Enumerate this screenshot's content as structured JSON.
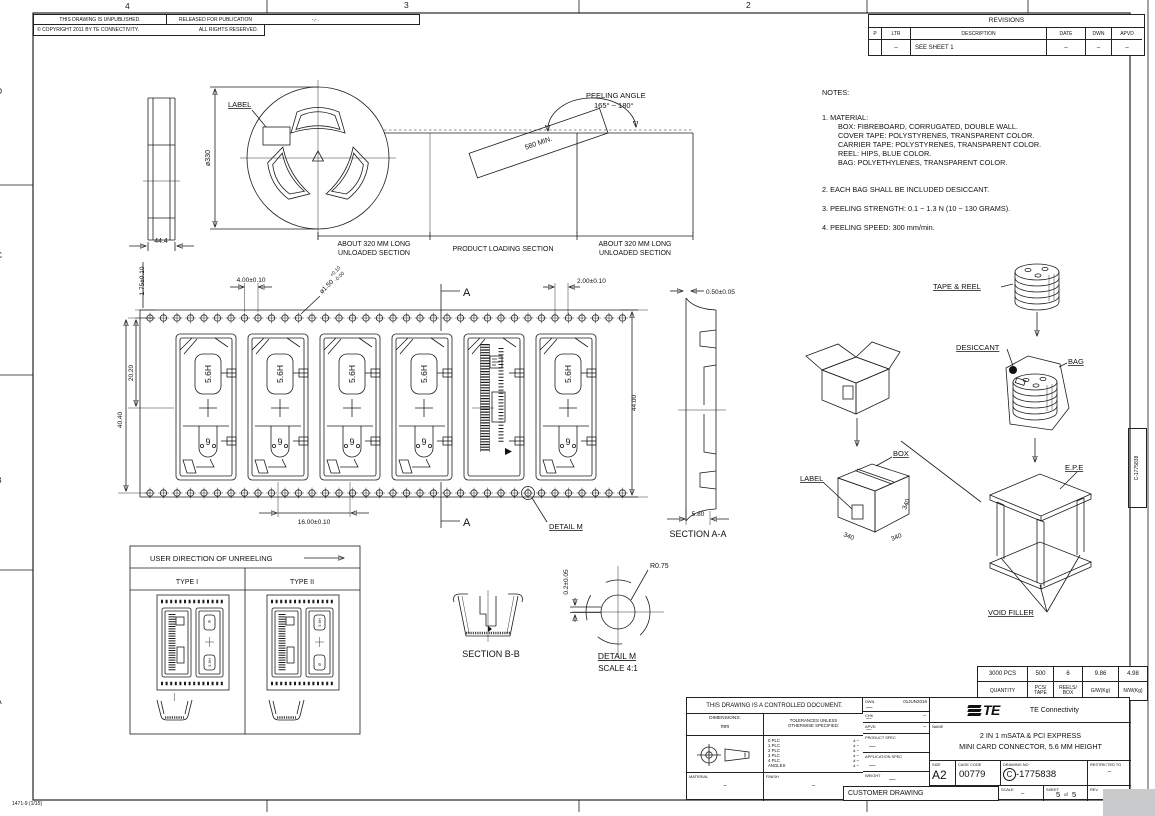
{
  "sheet": {
    "zone_top_4": "4",
    "zone_top_3": "3",
    "zone_top_2": "2",
    "zone_left_d": "D",
    "zone_left_c": "C",
    "zone_left_b": "B",
    "zone_left_a": "A",
    "form_number": "1471-9  (1/15)",
    "edge_label": "C-1775838"
  },
  "header": {
    "unpublished": "THIS DRAWING IS UNPUBLISHED.",
    "released": "RELEASED FOR PUBLICATION",
    "released_value": "-,-  .",
    "copyright": "© COPYRIGHT  2011  BY  TE  CONNECTIVITY.",
    "rights": "ALL RIGHTS RESERVED."
  },
  "revisions": {
    "title": "REVISIONS",
    "col_p": "P",
    "col_ltr": "LTR",
    "col_desc": "DESCRIPTION",
    "col_date": "DATE",
    "col_dwn": "DWN",
    "col_apvd": "APVD",
    "row_ltr": "–",
    "row_desc": "SEE SHEET 1",
    "row_date": "–",
    "row_dwn": "–",
    "row_apvd": "–"
  },
  "notes": {
    "title": "NOTES:",
    "n1": "1. MATERIAL:",
    "n1a": "BOX: FIBREBOARD, CORRUGATED, DOUBLE WALL.",
    "n1b": "COVER TAPE: POLYSTYRENES, TRANSPARENT COLOR.",
    "n1c": "CARRIER TAPE: POLYSTYRENES, TRANSPARENT COLOR.",
    "n1d": "REEL: HIPS, BLUE COLOR.",
    "n1e": "BAG: POLYETHYLENES, TRANSPARENT COLOR.",
    "n2": "2. EACH BAG SHALL BE INCLUDED DESICCANT.",
    "n3": "3. PEELING STRENGTH: 0.1 ~ 1.3 N (10 ~ 130 GRAMS).",
    "n4": "4. PEELING SPEED: 300 mm/min."
  },
  "reel": {
    "label": "LABEL",
    "diameter": "ø330",
    "width": "44.4",
    "peel_length": "580 MIN.",
    "peeling_angle_1": "PEELING ANGLE",
    "peeling_angle_2": "165° ~ 180°",
    "unloaded_1": "ABOUT 320 MM LONG",
    "unloaded_2": "UNLOADED SECTION",
    "loading": "PRODUCT LOADING SECTION"
  },
  "tape": {
    "d_pitch_edge": "1.75±0.10",
    "d_hole_pitch": "4.00±0.10",
    "d_hole_dia": "ø1.50",
    "d_hole_tol_p": "+0.10",
    "d_hole_tol_m": "-0.00",
    "d_edge_pocket": "2.00±0.10",
    "d_hole_to_center": "20.20",
    "d_hole_to_hole": "40.40",
    "d_width": "44.00",
    "d_pocket_pitch": "16.00±0.10",
    "marking_height": "5.6H",
    "marking_9": "9",
    "section_letter": "A",
    "detail_ref": "DETAIL M"
  },
  "section_aa": {
    "title": "SECTION A-A",
    "d_thickness": "0.50±0.05",
    "d_depth": "5.80"
  },
  "unreeling": {
    "title": "USER DIRECTION OF UNREELING",
    "type1": "TYPE I",
    "type2": "TYPE II"
  },
  "section_bb": {
    "title": "SECTION B-B"
  },
  "detail_m": {
    "title": "DETAIL M",
    "scale": "SCALE 4:1",
    "radius": "R0.75",
    "d_offset": "0.2±0.05"
  },
  "packaging": {
    "tape_reel": "TAPE & REEL",
    "desiccant": "DESICCANT",
    "bag": "BAG",
    "box": "BOX",
    "label": "LABEL",
    "epe": "E.P.E",
    "void_filler": "VOID FILLER",
    "dim_340": "340"
  },
  "quantity_table": {
    "v1": "3000 PCS",
    "v2": "500",
    "v3": "6",
    "v4": "9.86",
    "v5": "4.98",
    "l1": "QUANTITY",
    "l2a": "PCS/",
    "l2b": "TAPE",
    "l3a": "REELS/",
    "l3b": "BOX",
    "l4": "G/W(Kg)",
    "l5": "N/W(Kg)"
  },
  "title_block": {
    "controlled": "THIS DRAWING IS A CONTROLLED DOCUMENT.",
    "dwn_label": "DWN",
    "dwn_value": "—",
    "dwn_date": "01JUN2016",
    "chk_label": "CHK",
    "chk_right": "–",
    "chk_value": "—",
    "apvd_label": "APVD",
    "apvd_right": "–",
    "apvd_value": "—",
    "dimensions_label": "DIMENSIONS:",
    "dimensions_unit": "mm",
    "tol_line1": "TOLERANCES UNLESS",
    "tol_line2": "OTHERWISE SPECIFIED:",
    "plc0": "0 PLC",
    "plc1": "1 PLC",
    "plc2": "2 PLC",
    "plc3": "3 PLC",
    "plc4": "4 PLC",
    "plc_angles": "ANGLES",
    "tol_val": "±  –",
    "product_spec_label": "PRODUCT SPEC",
    "product_spec_value": "—",
    "application_spec_label": "APPLICATION SPEC",
    "application_spec_value": "—",
    "material_label": "MATERIAL",
    "material_value": "–",
    "finish_label": "FINISH",
    "finish_value": "–",
    "weight_label": "WEIGHT",
    "weight_value": "—",
    "customer_drawing": "CUSTOMER DRAWING",
    "logo_text": "TE",
    "company": "TE Connectivity",
    "name_label": "NAME",
    "name_line1": "2 IN 1 mSATA & PCI EXPRESS",
    "name_line2": "MINI CARD CONNECTOR, 5.6 MM HEIGHT",
    "size_label": "SIZE",
    "size_value": "A2",
    "cage_label": "CAGE CODE",
    "cage_value": "00779",
    "drawing_no_label": "DRAWING NO",
    "drawing_no_c": "C",
    "drawing_no_rest": "-1775838",
    "restricted_label": "RESTRICTED TO",
    "restricted_value": "–",
    "scale_label": "SCALE",
    "scale_value": "–",
    "sheet_label": "SHEET",
    "sheet_num": "5",
    "sheet_of": "of",
    "sheet_total": "5",
    "rev_label": "REV",
    "rev_value": "H"
  }
}
